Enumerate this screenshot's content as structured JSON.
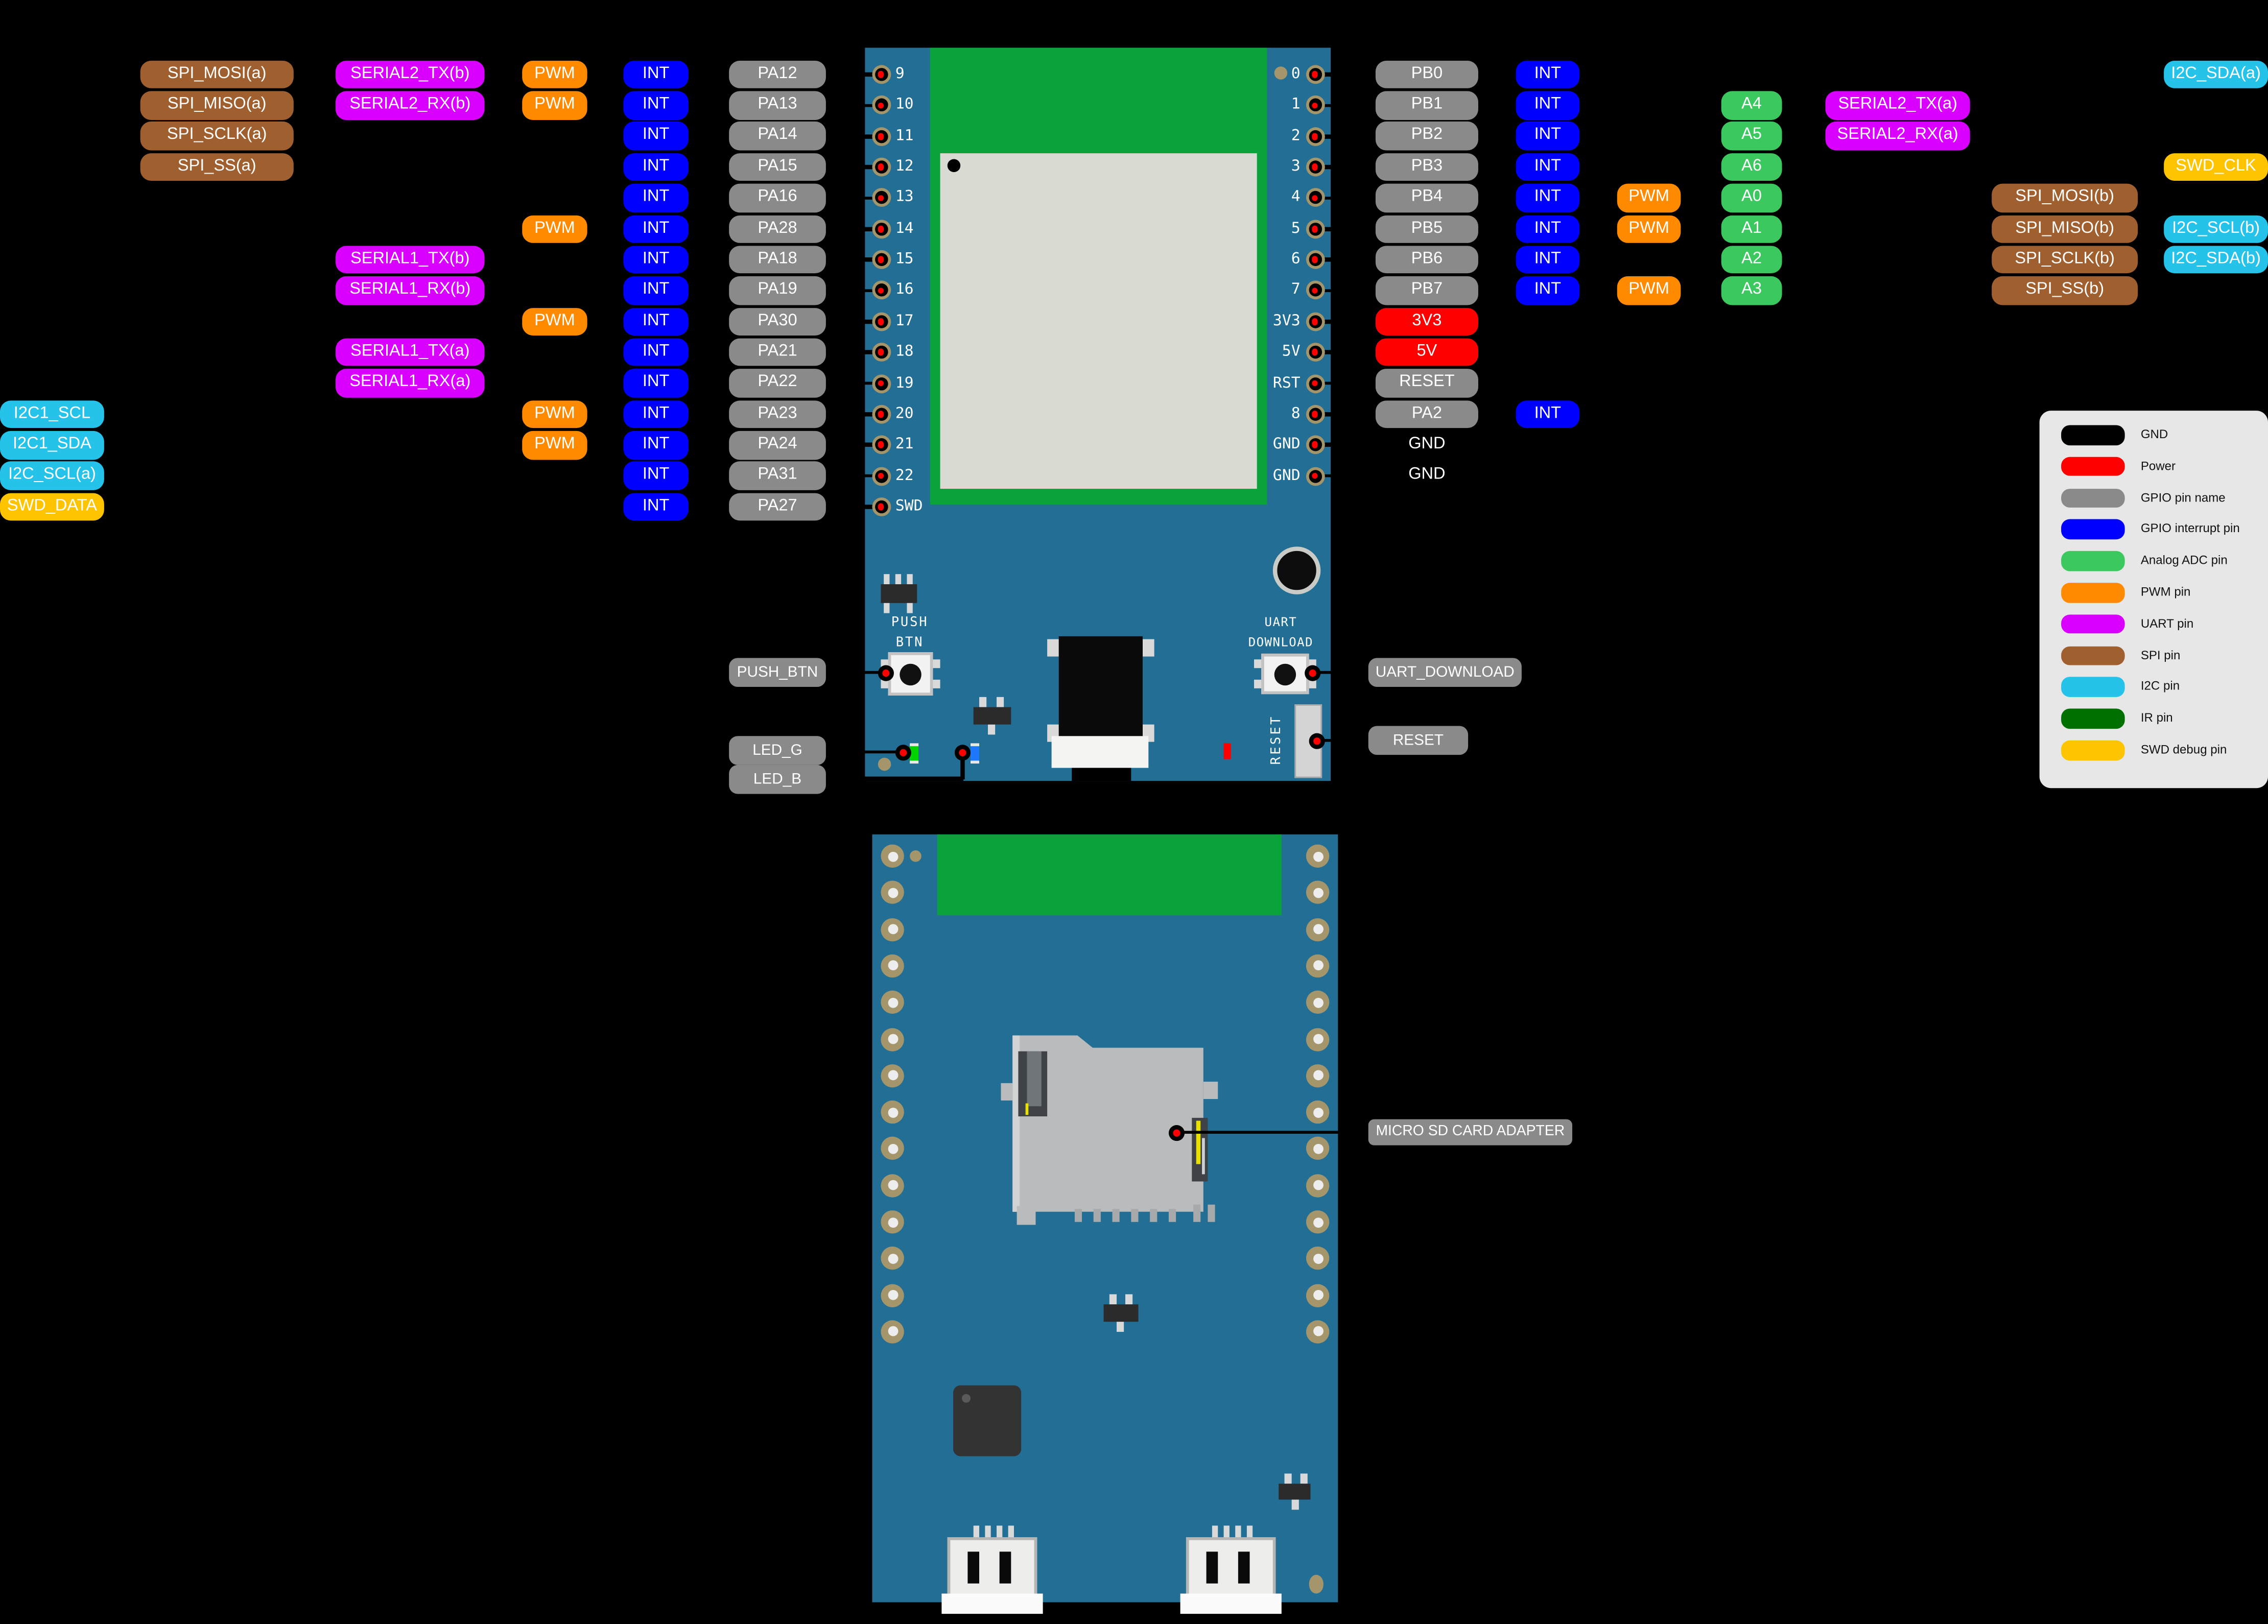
{
  "colors": {
    "vars": {
      "pcb": "#226E94",
      "module": "#0AA23A",
      "shield": "#D9DBD3",
      "ring": "#A4966A",
      "holered": "#FF0000",
      "holewhite": "#EDEDED",
      "legendbg": "#E7E7E7"
    },
    "types": {
      "gpio": "#8A8A8A",
      "int": "#0000FF",
      "pwm": "#FF8A00",
      "uart": "#D900FF",
      "spi": "#9F5F2E",
      "i2c": "#25C3EA",
      "swd": "#FFC400",
      "adc": "#3BC85F",
      "power": "#FF0000"
    }
  },
  "legend": {
    "items": [
      {
        "label": "GND",
        "color": "#000000"
      },
      {
        "label": "Power",
        "color": "#FF0000"
      },
      {
        "label": "GPIO pin name",
        "color": "#8A8A8A"
      },
      {
        "label": "GPIO interrupt pin",
        "color": "#0000FF"
      },
      {
        "label": "Analog ADC pin",
        "color": "#3BC85F"
      },
      {
        "label": "PWM pin",
        "color": "#FF8A00"
      },
      {
        "label": "UART pin",
        "color": "#D900FF"
      },
      {
        "label": "SPI pin",
        "color": "#9F5F2E"
      },
      {
        "label": "I2C pin",
        "color": "#25C3EA"
      },
      {
        "label": "IR pin",
        "color": "#007000"
      },
      {
        "label": "SWD debug pin",
        "color": "#FFC400"
      }
    ]
  },
  "left_rows": [
    {
      "chips": [
        {
          "col": "spi",
          "type": "spi",
          "text": "SPI_MOSI(a)"
        },
        {
          "col": "serial",
          "type": "uart",
          "text": "SERIAL2_TX(b)"
        },
        {
          "col": "pwm",
          "type": "pwm",
          "text": "PWM"
        },
        {
          "col": "int",
          "type": "int",
          "text": "INT"
        },
        {
          "col": "pa",
          "type": "gpio",
          "text": "PA12"
        }
      ]
    },
    {
      "chips": [
        {
          "col": "spi",
          "type": "spi",
          "text": "SPI_MISO(a)"
        },
        {
          "col": "serial",
          "type": "uart",
          "text": "SERIAL2_RX(b)"
        },
        {
          "col": "pwm",
          "type": "pwm",
          "text": "PWM"
        },
        {
          "col": "int",
          "type": "int",
          "text": "INT"
        },
        {
          "col": "pa",
          "type": "gpio",
          "text": "PA13"
        }
      ]
    },
    {
      "chips": [
        {
          "col": "spi",
          "type": "spi",
          "text": "SPI_SCLK(a)"
        },
        {
          "col": "int",
          "type": "int",
          "text": "INT"
        },
        {
          "col": "pa",
          "type": "gpio",
          "text": "PA14"
        }
      ]
    },
    {
      "chips": [
        {
          "col": "spi",
          "type": "spi",
          "text": "SPI_SS(a)"
        },
        {
          "col": "int",
          "type": "int",
          "text": "INT"
        },
        {
          "col": "pa",
          "type": "gpio",
          "text": "PA15"
        }
      ]
    },
    {
      "chips": [
        {
          "col": "int",
          "type": "int",
          "text": "INT"
        },
        {
          "col": "pa",
          "type": "gpio",
          "text": "PA16"
        }
      ]
    },
    {
      "chips": [
        {
          "col": "pwm",
          "type": "pwm",
          "text": "PWM"
        },
        {
          "col": "int",
          "type": "int",
          "text": "INT"
        },
        {
          "col": "pa",
          "type": "gpio",
          "text": "PA28"
        }
      ]
    },
    {
      "chips": [
        {
          "col": "serial",
          "type": "uart",
          "text": "SERIAL1_TX(b)"
        },
        {
          "col": "int",
          "type": "int",
          "text": "INT"
        },
        {
          "col": "pa",
          "type": "gpio",
          "text": "PA18"
        }
      ]
    },
    {
      "chips": [
        {
          "col": "serial",
          "type": "uart",
          "text": "SERIAL1_RX(b)"
        },
        {
          "col": "int",
          "type": "int",
          "text": "INT"
        },
        {
          "col": "pa",
          "type": "gpio",
          "text": "PA19"
        }
      ]
    },
    {
      "chips": [
        {
          "col": "pwm",
          "type": "pwm",
          "text": "PWM"
        },
        {
          "col": "int",
          "type": "int",
          "text": "INT"
        },
        {
          "col": "pa",
          "type": "gpio",
          "text": "PA30"
        }
      ]
    },
    {
      "chips": [
        {
          "col": "serial",
          "type": "uart",
          "text": "SERIAL1_TX(a)"
        },
        {
          "col": "int",
          "type": "int",
          "text": "INT"
        },
        {
          "col": "pa",
          "type": "gpio",
          "text": "PA21"
        }
      ]
    },
    {
      "chips": [
        {
          "col": "serial",
          "type": "uart",
          "text": "SERIAL1_RX(a)"
        },
        {
          "col": "int",
          "type": "int",
          "text": "INT"
        },
        {
          "col": "pa",
          "type": "gpio",
          "text": "PA22"
        }
      ]
    },
    {
      "chips": [
        {
          "col": "far",
          "type": "i2c",
          "text": "I2C1_SCL"
        },
        {
          "col": "pwm",
          "type": "pwm",
          "text": "PWM"
        },
        {
          "col": "int",
          "type": "int",
          "text": "INT"
        },
        {
          "col": "pa",
          "type": "gpio",
          "text": "PA23"
        }
      ]
    },
    {
      "chips": [
        {
          "col": "far",
          "type": "i2c",
          "text": "I2C1_SDA"
        },
        {
          "col": "pwm",
          "type": "pwm",
          "text": "PWM"
        },
        {
          "col": "int",
          "type": "int",
          "text": "INT"
        },
        {
          "col": "pa",
          "type": "gpio",
          "text": "PA24"
        }
      ]
    },
    {
      "chips": [
        {
          "col": "far",
          "type": "i2c",
          "text": "I2C_SCL(a)"
        },
        {
          "col": "int",
          "type": "int",
          "text": "INT"
        },
        {
          "col": "pa",
          "type": "gpio",
          "text": "PA31"
        }
      ]
    },
    {
      "chips": [
        {
          "col": "far",
          "type": "swd",
          "text": "SWD_DATA"
        },
        {
          "col": "int",
          "type": "int",
          "text": "INT"
        },
        {
          "col": "pa",
          "type": "gpio",
          "text": "PA27"
        }
      ]
    }
  ],
  "right_rows": [
    {
      "chips": [
        {
          "col": "pb",
          "type": "gpio",
          "text": "PB0"
        },
        {
          "col": "int",
          "type": "int",
          "text": "INT"
        },
        {
          "col": "i2c",
          "type": "i2c",
          "text": "I2C_SDA(a)"
        }
      ]
    },
    {
      "chips": [
        {
          "col": "pb",
          "type": "gpio",
          "text": "PB1"
        },
        {
          "col": "int",
          "type": "int",
          "text": "INT"
        },
        {
          "col": "a",
          "type": "adc",
          "text": "A4"
        },
        {
          "col": "serial",
          "type": "uart",
          "text": "SERIAL2_TX(a)"
        }
      ]
    },
    {
      "chips": [
        {
          "col": "pb",
          "type": "gpio",
          "text": "PB2"
        },
        {
          "col": "int",
          "type": "int",
          "text": "INT"
        },
        {
          "col": "a",
          "type": "adc",
          "text": "A5"
        },
        {
          "col": "serial",
          "type": "uart",
          "text": "SERIAL2_RX(a)"
        }
      ]
    },
    {
      "chips": [
        {
          "col": "pb",
          "type": "gpio",
          "text": "PB3"
        },
        {
          "col": "int",
          "type": "int",
          "text": "INT"
        },
        {
          "col": "a",
          "type": "adc",
          "text": "A6"
        },
        {
          "col": "i2c",
          "type": "swd",
          "text": "SWD_CLK"
        }
      ]
    },
    {
      "chips": [
        {
          "col": "pb",
          "type": "gpio",
          "text": "PB4"
        },
        {
          "col": "int",
          "type": "int",
          "text": "INT"
        },
        {
          "col": "pwm",
          "type": "pwm",
          "text": "PWM"
        },
        {
          "col": "a",
          "type": "adc",
          "text": "A0"
        },
        {
          "col": "spi",
          "type": "spi",
          "text": "SPI_MOSI(b)"
        }
      ]
    },
    {
      "chips": [
        {
          "col": "pb",
          "type": "gpio",
          "text": "PB5"
        },
        {
          "col": "int",
          "type": "int",
          "text": "INT"
        },
        {
          "col": "pwm",
          "type": "pwm",
          "text": "PWM"
        },
        {
          "col": "a",
          "type": "adc",
          "text": "A1"
        },
        {
          "col": "spi",
          "type": "spi",
          "text": "SPI_MISO(b)"
        },
        {
          "col": "i2c",
          "type": "i2c",
          "text": "I2C_SCL(b)"
        }
      ]
    },
    {
      "chips": [
        {
          "col": "pb",
          "type": "gpio",
          "text": "PB6"
        },
        {
          "col": "int",
          "type": "int",
          "text": "INT"
        },
        {
          "col": "a",
          "type": "adc",
          "text": "A2"
        },
        {
          "col": "spi",
          "type": "spi",
          "text": "SPI_SCLK(b)"
        },
        {
          "col": "i2c",
          "type": "i2c",
          "text": "I2C_SDA(b)"
        }
      ]
    },
    {
      "chips": [
        {
          "col": "pb",
          "type": "gpio",
          "text": "PB7"
        },
        {
          "col": "int",
          "type": "int",
          "text": "INT"
        },
        {
          "col": "pwm",
          "type": "pwm",
          "text": "PWM"
        },
        {
          "col": "a",
          "type": "adc",
          "text": "A3"
        },
        {
          "col": "spi",
          "type": "spi",
          "text": "SPI_SS(b)"
        }
      ]
    },
    {
      "chips": [
        {
          "col": "pb",
          "type": "power",
          "text": "3V3"
        }
      ]
    },
    {
      "chips": [
        {
          "col": "pb",
          "type": "power",
          "text": "5V"
        }
      ]
    },
    {
      "chips": [
        {
          "col": "pb",
          "type": "gpio",
          "text": "RESET"
        }
      ]
    },
    {
      "chips": [
        {
          "col": "pb",
          "type": "gpio",
          "text": "PA2"
        },
        {
          "col": "int",
          "type": "int",
          "text": "INT"
        }
      ]
    },
    {
      "chips": [
        {
          "col": "pb",
          "type": "gndtext",
          "text": "GND"
        }
      ]
    },
    {
      "chips": [
        {
          "col": "pb",
          "type": "gndtext",
          "text": "GND"
        }
      ]
    }
  ],
  "board1": {
    "left_pins": [
      "9",
      "10",
      "11",
      "12",
      "13",
      "14",
      "15",
      "16",
      "17",
      "18",
      "19",
      "20",
      "21",
      "22",
      "SWD"
    ],
    "right_pins": [
      "0",
      "1",
      "2",
      "3",
      "4",
      "5",
      "6",
      "7",
      "3V3",
      "5V",
      "RST",
      "8",
      "GND",
      "GND"
    ],
    "silk": {
      "push1": "PUSH",
      "push2": "BTN",
      "uart1": "UART",
      "uart2": "DOWNLOAD",
      "reset": "RESET"
    }
  },
  "board2": {
    "pad_rows": 14
  },
  "callouts": {
    "push_btn": "PUSH_BTN",
    "led_g": "LED_G",
    "led_b": "LED_B",
    "uart_download": "UART_DOWNLOAD",
    "reset": "RESET",
    "sd": "MICRO SD CARD ADAPTER"
  }
}
